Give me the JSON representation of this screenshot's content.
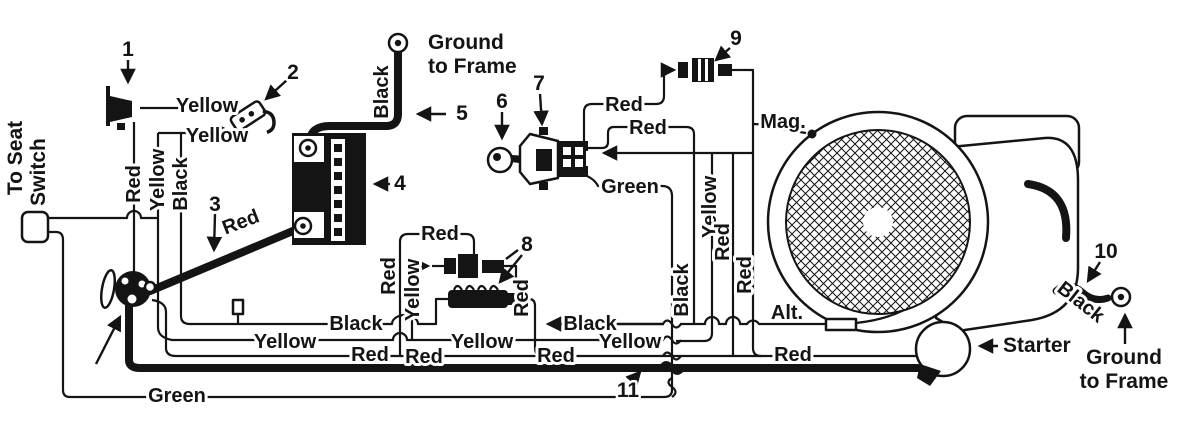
{
  "palette": {
    "ink": "#141414",
    "paper": "#ffffff"
  },
  "labels": {
    "to_seat_line1": "To Seat",
    "to_seat_line2": "Switch",
    "ground_top_line1": "Ground",
    "ground_top_line2": "to Frame",
    "ground_right_line1": "Ground",
    "ground_right_line2": "to Frame",
    "mag": "Mag.",
    "alt": "Alt.",
    "starter": "Starter"
  },
  "callouts": {
    "c1": "1",
    "c2": "2",
    "c3": "3",
    "c4": "4",
    "c5": "5",
    "c6": "6",
    "c7": "7",
    "c8": "8",
    "c9": "9",
    "c10": "10",
    "c11": "11"
  },
  "wire_labels": {
    "yellow_top_a": "Yellow",
    "yellow_top_b": "Yellow",
    "yellow_vert_left": "Yellow",
    "yellow_vert_fuse": "Yellow",
    "yellow_vert_engine": "Yellow",
    "yellow_run_a": "Yellow",
    "yellow_run_b": "Yellow",
    "yellow_run_c": "Yellow",
    "red_vert_left": "Red",
    "red_cable3": "Red",
    "red_fuse_top": "Red",
    "red_vert_fuse": "Red",
    "red_vert_fuseblock": "Red",
    "red_switch_a": "Red",
    "red_switch_b": "Red",
    "red_vert_engine_a": "Red",
    "red_vert_engine_b": "Red",
    "red_run_a": "Red",
    "red_run_b": "Red",
    "red_run_c": "Red",
    "red_run_starter": "Red",
    "black_vert_left": "Black",
    "black_cable5": "Black",
    "black_run_a": "Black",
    "black_run_b": "Black",
    "black_vert_engine": "Black",
    "black_ground10": "Black",
    "green_switch": "Green",
    "green_run": "Green"
  }
}
